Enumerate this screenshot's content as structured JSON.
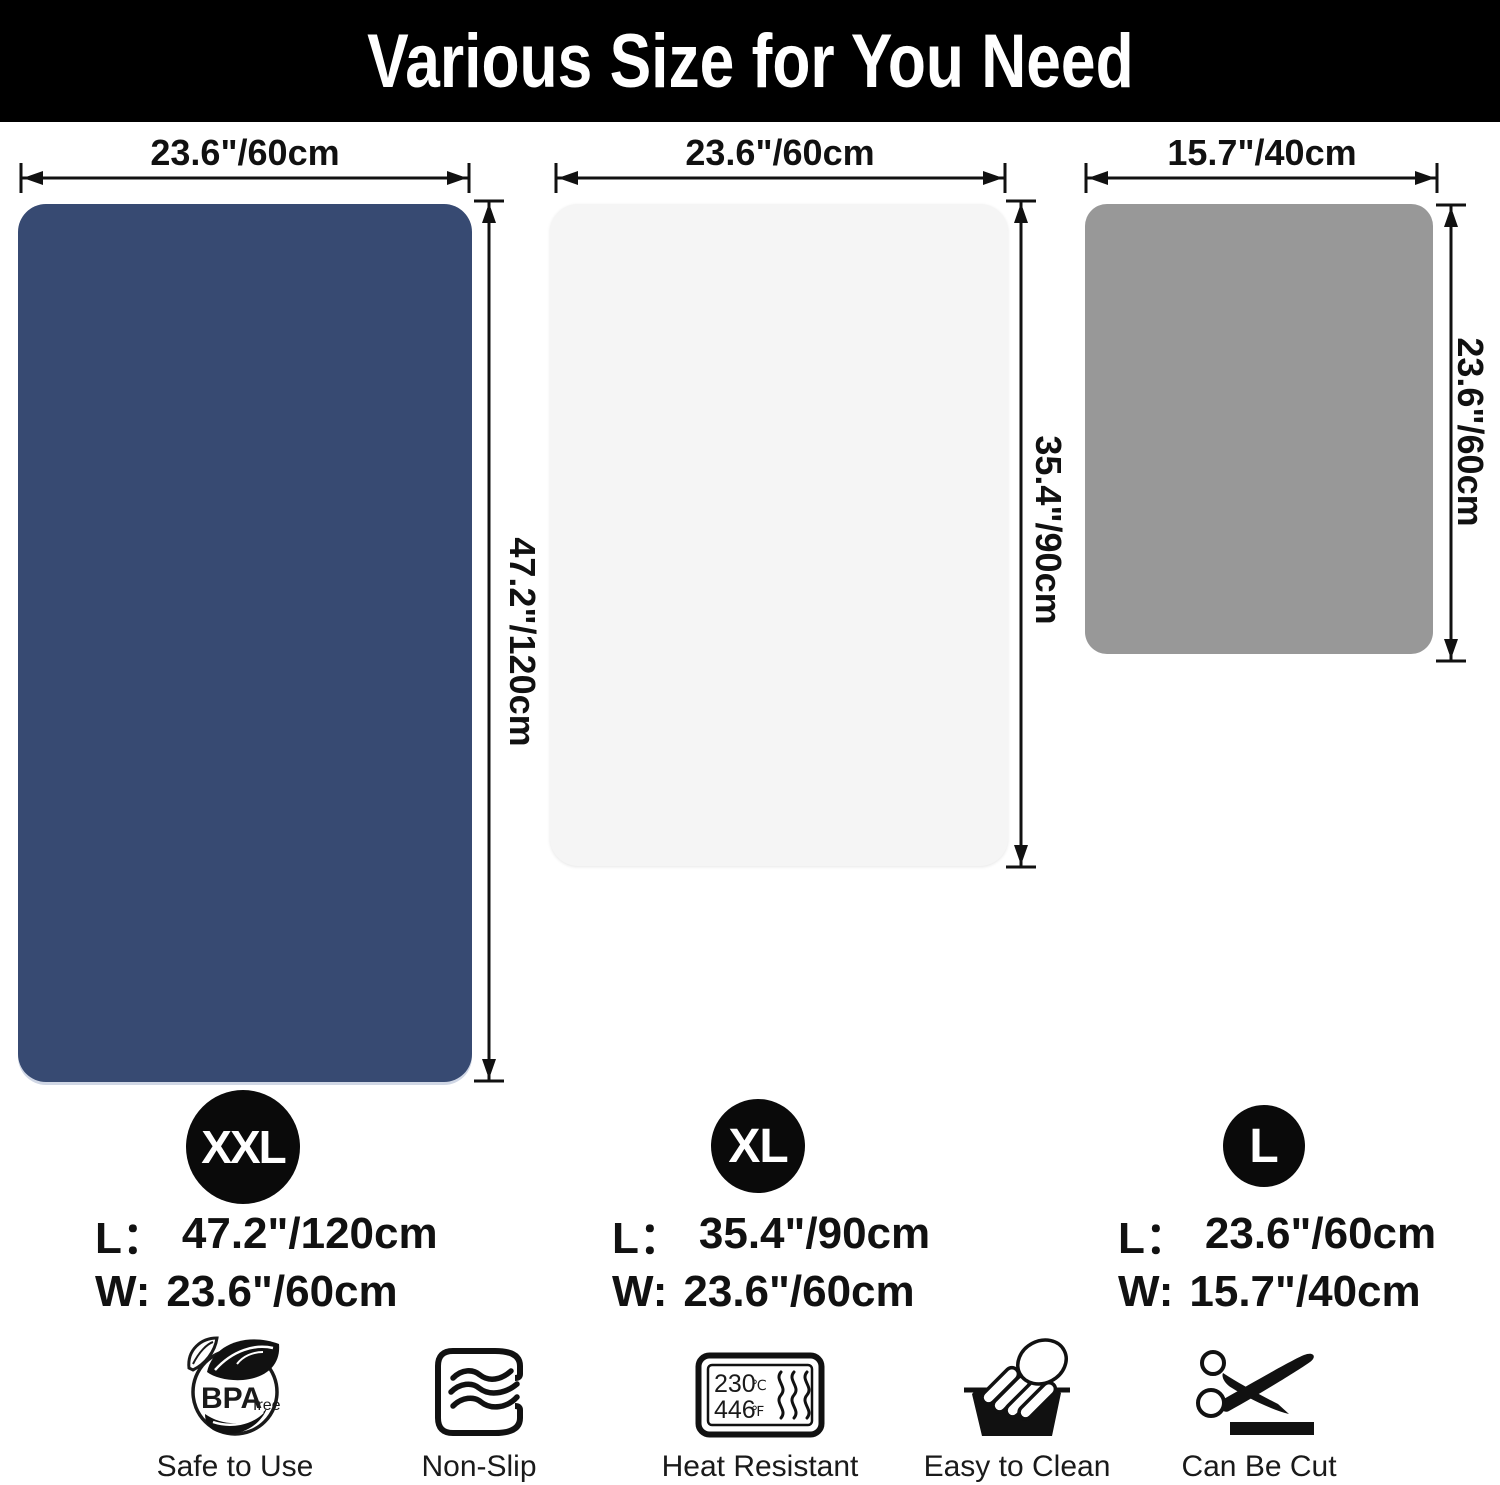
{
  "header": {
    "title": "Various Size for You Need",
    "bg_color": "#000000",
    "text_color": "#ffffff"
  },
  "mats": [
    {
      "name": "XXL mat",
      "color": "#374a72",
      "top_dim": "23.6\"/60cm",
      "side_dim": "47.2\"/120cm"
    },
    {
      "name": "XL mat",
      "color": "#f5f5f5",
      "top_dim": "23.6\"/60cm",
      "side_dim": "35.4\"/90cm"
    },
    {
      "name": "L mat",
      "color": "#989898",
      "top_dim": "15.7\"/40cm",
      "side_dim": "23.6\"/60cm"
    }
  ],
  "sizes": [
    {
      "badge": "XXL",
      "length_label": "L：",
      "length_value": "47.2\"/120cm",
      "width_label": "W:",
      "width_value": "23.6\"/60cm"
    },
    {
      "badge": "XL",
      "length_label": "L：",
      "length_value": "35.4\"/90cm",
      "width_label": "W:",
      "width_value": "23.6\"/60cm"
    },
    {
      "badge": "L",
      "length_label": "L：",
      "length_value": "23.6\"/60cm",
      "width_label": "W:",
      "width_value": "15.7\"/40cm"
    }
  ],
  "features": [
    {
      "icon": "bpa-free-icon",
      "label": "Safe to Use",
      "bpa": "BPA",
      "free": "free"
    },
    {
      "icon": "non-slip-icon",
      "label": "Non-Slip"
    },
    {
      "icon": "heat-resistant-icon",
      "label": "Heat Resistant",
      "temp_c_value": "230",
      "temp_c_unit": "℃",
      "temp_f_value": "446",
      "temp_f_unit": "℉"
    },
    {
      "icon": "hand-wash-icon",
      "label": "Easy to Clean"
    },
    {
      "icon": "scissors-icon",
      "label": "Can Be Cut"
    }
  ]
}
